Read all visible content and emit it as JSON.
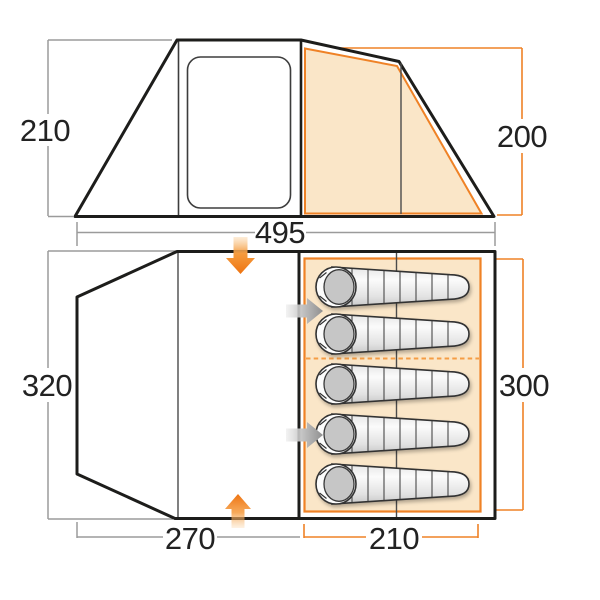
{
  "diagram_type": "tent-dimensions-floorplan",
  "colors": {
    "accent_orange": "#EF8226",
    "light_orange_fill": "#FAE6C8",
    "dashed_divider_orange": "#F59D45",
    "outline_black": "#1D1D1B",
    "dimension_gray": "#9A9A9A",
    "sleeping_bag_gray": "#C6C6C6"
  },
  "side_view": {
    "left_height_label": "210",
    "right_height_label": "200",
    "total_width_label": "495"
  },
  "floor_plan": {
    "left_height_label": "320",
    "bedroom_depth_label": "300",
    "living_area_width_label": "270",
    "bedroom_width_label": "210",
    "sleeping_bag_count": 5
  }
}
